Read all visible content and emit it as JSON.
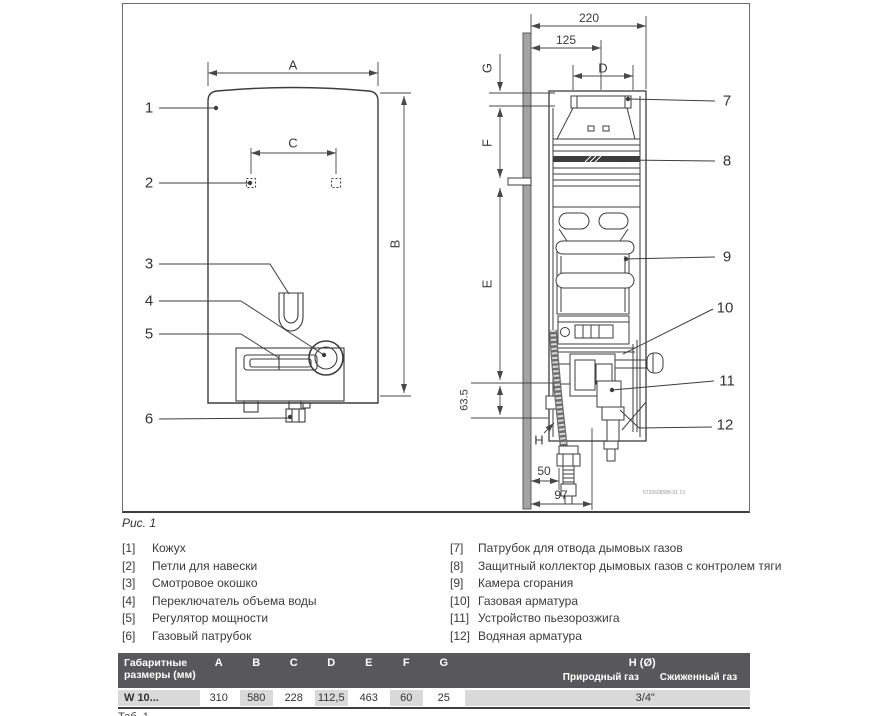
{
  "figure": {
    "caption": "Рис. 1",
    "drawing_code": "6720608588-01.1V",
    "callouts": [
      "1",
      "2",
      "3",
      "4",
      "5",
      "6",
      "7",
      "8",
      "9",
      "10",
      "11",
      "12"
    ],
    "dim_labels": {
      "a": "A",
      "b": "B",
      "c": "C",
      "d": "D",
      "e": "E",
      "f": "F",
      "g": "G",
      "h": "H",
      "wall_offset_total": "220",
      "wall_offset_upper": "125",
      "flue_offset": "63.5",
      "hose_offset": "50",
      "gas_offset": "97"
    }
  },
  "legend": {
    "left": [
      {
        "num": "[1]",
        "text": "Кожух"
      },
      {
        "num": "[2]",
        "text": "Петли для навески"
      },
      {
        "num": "[3]",
        "text": "Смотровое окошко"
      },
      {
        "num": "[4]",
        "text": "Переключатель объема воды"
      },
      {
        "num": "[5]",
        "text": "Регулятор мощности"
      },
      {
        "num": "[6]",
        "text": "Газовый патрубок"
      }
    ],
    "right": [
      {
        "num": "[7]",
        "text": "Патрубок для отвода дымовых газов"
      },
      {
        "num": "[8]",
        "text": "Защитный коллектор дымовых газов с контролем тяги"
      },
      {
        "num": "[9]",
        "text": "Камера сгорания"
      },
      {
        "num": "[10]",
        "text": "Газовая арматура"
      },
      {
        "num": "[11]",
        "text": "Устройство пьезорозжига"
      },
      {
        "num": "[12]",
        "text": "Водяная арматура"
      }
    ]
  },
  "table": {
    "header_label": "Габаритные размеры (мм)",
    "columns": [
      "A",
      "B",
      "C",
      "D",
      "E",
      "F",
      "G"
    ],
    "h_column": "H (Ø)",
    "h_sub": [
      "Природный газ",
      "Сжиженный газ"
    ],
    "row_label": "W 10...",
    "values": [
      "310",
      "580",
      "228",
      "112,5",
      "463",
      "60",
      "25"
    ],
    "h_value": "3/4\"",
    "caption": "Таб. 1"
  },
  "colors": {
    "line": "#3d3d3d",
    "table_header_bg": "#58585a",
    "table_cell_gray": "#d9d9d9"
  }
}
